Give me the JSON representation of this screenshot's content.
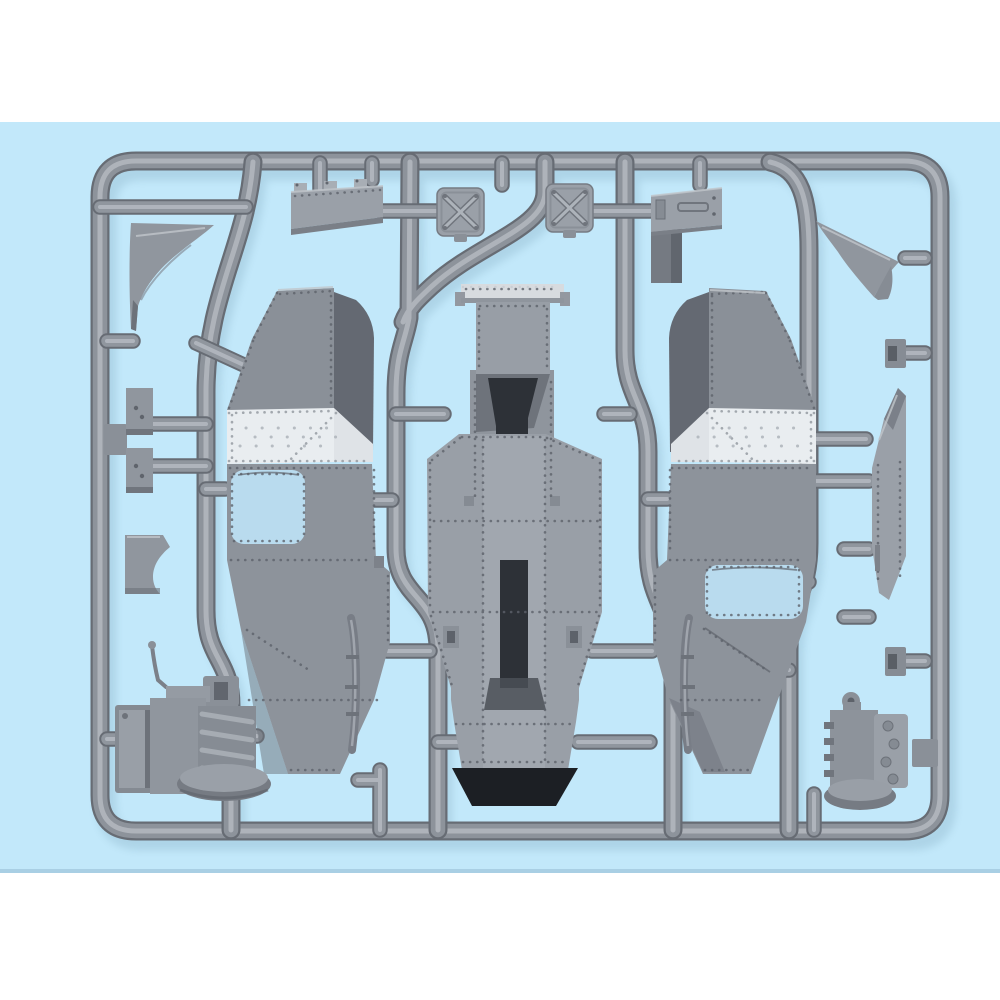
{
  "scene": {
    "type": "product-photo",
    "subject": "Injection-molded model kit sprue (gray styrene) with armored-vehicle hull parts on a light blue backdrop",
    "visible_text": ""
  },
  "colors": {
    "page_background": "#ffffff",
    "backdrop_blue": "#c2e8fa",
    "backdrop_edge": "#a9cfe4",
    "sprue_base": "#8d939b",
    "sprue_shadow": "#676c74",
    "sprue_highlight": "#b4b9c0",
    "part_face": "#999fa7",
    "part_dark": "#646972",
    "white_panel": "#e9edf0",
    "white_panel_shaded": "#dfe3e7",
    "opening_dark": "#1c1f24",
    "slot_dark": "#2d3137",
    "window_blue": "#b9dbee"
  },
  "parts": {
    "frame": "Sprue outer frame",
    "runners": "Inner sprue runners and feed gates",
    "hull_left": "Riveted armored hull side panel (left)",
    "hull_right": "Riveted armored hull side panel (right)",
    "hull_center": "Riveted hull center / rear section",
    "plate_hinged": "Hinged access plate",
    "hatch_x_1": "X-braced square hatch",
    "hatch_x_2": "X-braced square hatch",
    "plate_latched": "Latched access plate",
    "bracket_left": "Triangular bracket (left)",
    "bracket_right": "Triangular bracket (right)",
    "small_plate_1": "Small bolted plate",
    "small_plate_2": "Small bolted plate",
    "step_bracket": "Step bracket",
    "engine_left": "Engine with radiator and shift lever",
    "engine_right": "Engine / gearbox block",
    "fender": "Fender side strip",
    "clip_1": "Mounting clip",
    "clip_2": "Mounting clip",
    "leaf_spring_left": "Leaf spring",
    "leaf_spring_right": "Leaf spring"
  }
}
